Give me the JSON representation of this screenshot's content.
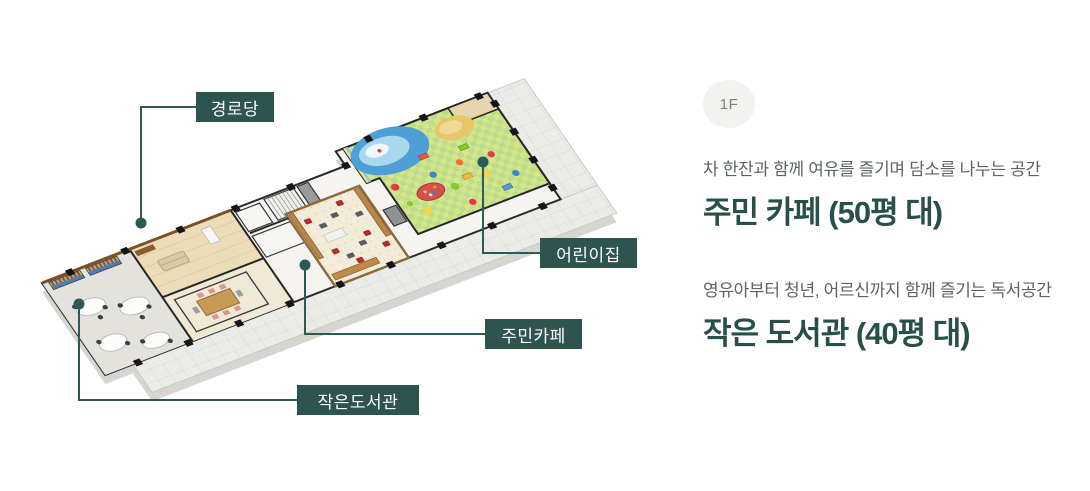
{
  "floorplan": {
    "labels": [
      {
        "id": "senior-center",
        "text": "경로당"
      },
      {
        "id": "daycare",
        "text": "어린이집"
      },
      {
        "id": "resident-cafe",
        "text": "주민카페"
      },
      {
        "id": "small-library",
        "text": "작은도서관"
      }
    ]
  },
  "info": {
    "floor_badge": "1F",
    "sections": [
      {
        "subtitle": "차 한잔과 함께 여유를 즐기며 담소를 나누는 공간",
        "title": "주민 카페 (50평 대)"
      },
      {
        "subtitle": "영유아부터 청년, 어르신까지 함께 즐기는 독서공간",
        "title": "작은 도서관 (40평 대)"
      }
    ]
  },
  "colors": {
    "accent_title": "#294f4a",
    "label_box": "#2e5450",
    "leader_line": "#2e5a55",
    "badge_bg": "#f2f2ef",
    "badge_text": "#7a8284",
    "subtitle_text": "#5d6467",
    "daycare_floor": "#bedc8e",
    "pool_blue": "#4d9fd6",
    "wood_floor": "#ecdcb8"
  }
}
